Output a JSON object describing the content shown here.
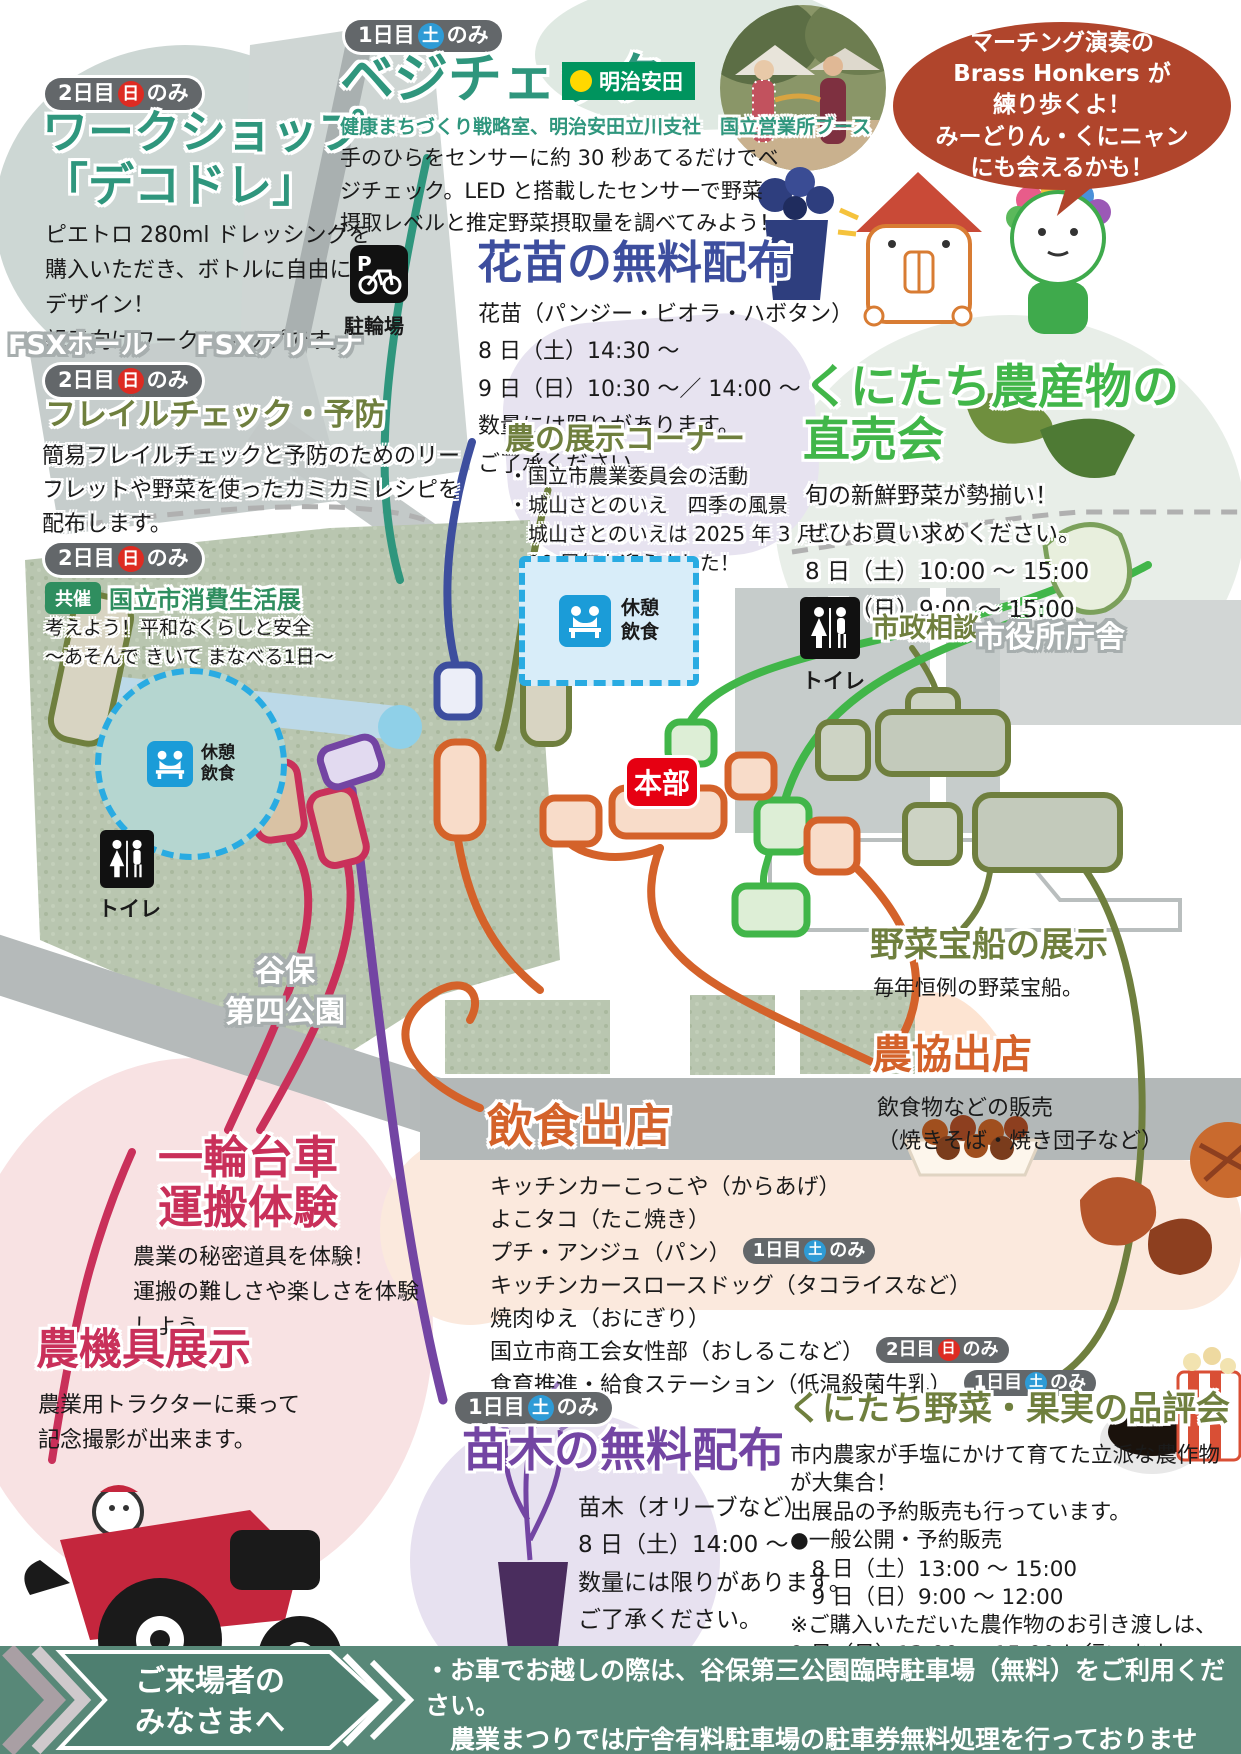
{
  "badge_day1": {
    "prefix": "1日目",
    "day": "土",
    "suffix": "のみ"
  },
  "badge_day2": {
    "prefix": "2日目",
    "day": "日",
    "suffix": "のみ"
  },
  "workshop": {
    "title": "ワークショップ\n「デコドレ」",
    "body": "ピエトロ 280ml ドレッシングを\n購入いただき、ボトルに自由に\nデザイン！\n親子向けワークショップです。"
  },
  "frailty": {
    "title": "フレイルチェック・予防",
    "body": "簡易フレイルチェックと予防のためのリー\nフレットや野菜を使ったカミカミレシピを\n配布します。"
  },
  "consumer": {
    "kyosai": "共催",
    "title": "国立市消費生活展",
    "body": "考えよう！平和なくらしと安全\n～あそんで きいて まなべる1日～"
  },
  "vegecheck": {
    "title": "ベジチェック",
    "sponsor": "明治安田",
    "subtitle": "健康まちづくり戦略室、明治安田立川支社　国立営業所ブース",
    "body": "手のひらをセンサーに約 30 秒あてるだけでベ\nジチェック。LED と搭載したセンサーで野菜\n摂取レベルと推定野菜摂取量を調べてみよう！"
  },
  "hanae": {
    "title": "花苗の無料配布",
    "body": "花苗（パンジー・ビオラ・ハボタン）\n8 日（土）14:30 ～\n9 日（日）10:30 ～／ 14:00 ～\n数量には限りがあります。\nご了承ください。"
  },
  "tenji": {
    "title": "農の展示コーナー",
    "body": "・国立市農業委員会の活動\n・城山さとのいえ　四季の風景\n　城山さとのいえは 2025 年 3 月に\n　10 周年を迎えました！"
  },
  "bubble": {
    "text": "マーチング演奏の\nBrass Honkers が\n練り歩くよ！\nみーどりん・くにニャン\nにも会えるかも！"
  },
  "chokubai": {
    "title": "くにたち農産物の\n直売会",
    "body": "旬の新鮮野菜が勢揃い！\nぜひお買い求めください。\n8 日（土）10:00 ～ 15:00\n9 日（日）9:00 ～ 15:00"
  },
  "takarabune": {
    "title": "野菜宝船の展示",
    "body": "毎年恒例の野菜宝船。"
  },
  "nokyo": {
    "title": "農協出店",
    "body": "飲食物などの販売\n（焼きそば・焼き団子など）"
  },
  "inshoku": {
    "title": "飲食出店",
    "items": [
      {
        "label": "キッチンカーこっこや（からあげ）"
      },
      {
        "label": "よこタコ（たこ焼き）"
      },
      {
        "label": "プチ・アンジュ（パン）"
      },
      {
        "label": "キッチンカースロースドッグ（タコライスなど）"
      },
      {
        "label": "焼肉ゆえ（おにぎり）"
      },
      {
        "label": "国立市商工会女性部（おしるこなど）"
      },
      {
        "label": "食育推進・給食ステーション（低温殺菌牛乳）"
      }
    ]
  },
  "ichirin": {
    "title": "一輪台車\n運搬体験",
    "body": "農業の秘密道具を体験！\n運搬の難しさや楽しさを体験\nしよう。"
  },
  "noukigu": {
    "title": "農機具展示",
    "body": "農業用トラクターに乗って\n記念撮影が出来ます。"
  },
  "naegi": {
    "title": "苗木の無料配布",
    "body": "苗木（オリーブなど）\n8 日（土）14:00 ～\n数量には限りがあります。\nご了承ください。"
  },
  "hinpyokai": {
    "title": "くにたち野菜・果実の品評会",
    "body": "市内農家が手塩にかけて育てた立派な農作物\nが大集合！\n出展品の予約販売も行っています。\n●一般公開・予約販売\n　8 日（土）13:00 ～ 15:00\n　9 日（日）9:00 ～ 12:00\n※ご購入いただいた農作物のお引き渡しは、\n9 日（日）13:00 ～ 15:00 に行います"
  },
  "map": {
    "fsx_hall": "FSXホール",
    "fsx_arena": "FSXアリーナ",
    "parking_p": "P",
    "parking_label": "駐輪場",
    "rest": "休憩\n飲食",
    "honbu": "本部",
    "toilet": "トイレ",
    "shisei": "市政相談",
    "cityhall": "市役所庁舎",
    "park_name": "谷保\n第四公園"
  },
  "mascots": {
    "m_badge": "M"
  },
  "footer": {
    "label": "ご来場者の\nみなさまへ",
    "body": "・お車でお越しの際は、谷保第三公園臨時駐車場（無料）をご利用ください。\n　農業まつりでは庁舎有料駐車場の駐車券無料処理を行っておりません。\n・一部イベント内容が変更となる可能性があります。"
  },
  "colors": {
    "teal_green": "#2f967d",
    "olive": "#6f7f3e",
    "bright_green": "#41b649",
    "blue_title": "#3d4e9e",
    "orange": "#d4622a",
    "crimson": "#c9305a",
    "purple": "#7345a3",
    "red_honbu": "#e60012",
    "rust_bubble": "#b0452c",
    "footer_teal": "#588878",
    "badge_gray": "#63676a",
    "sun_red": "#dd2b22",
    "sat_blue": "#2e9bd6",
    "meiji_green": "#00945e",
    "dash_blue": "#29abe2"
  }
}
